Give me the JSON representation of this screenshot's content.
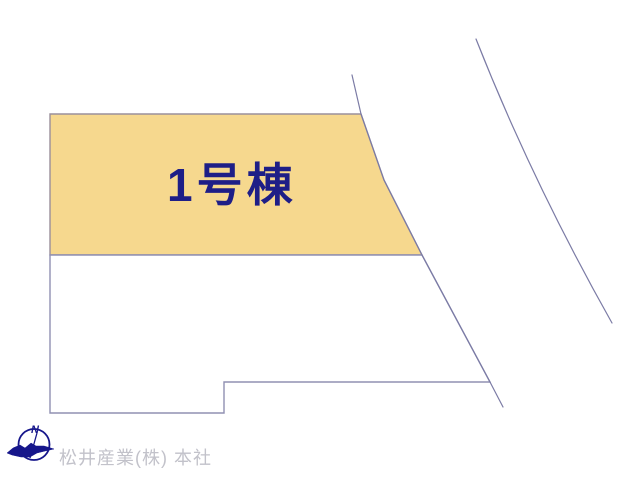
{
  "plan": {
    "building_label": "1号棟",
    "watermark_text": "松井産業(株) 本社",
    "compass": {
      "north_label": "N"
    }
  },
  "colors": {
    "background": "#FFFFFF",
    "lot_fill": "#F6D88E",
    "lot_border": "#9A8F9B",
    "parcel_border": "#9090B2",
    "road_line": "#7B7BA5",
    "building_label_text": "#1E1E87",
    "watermark_text_color": "#C2C2CA",
    "compass_navy": "#16168B"
  }
}
